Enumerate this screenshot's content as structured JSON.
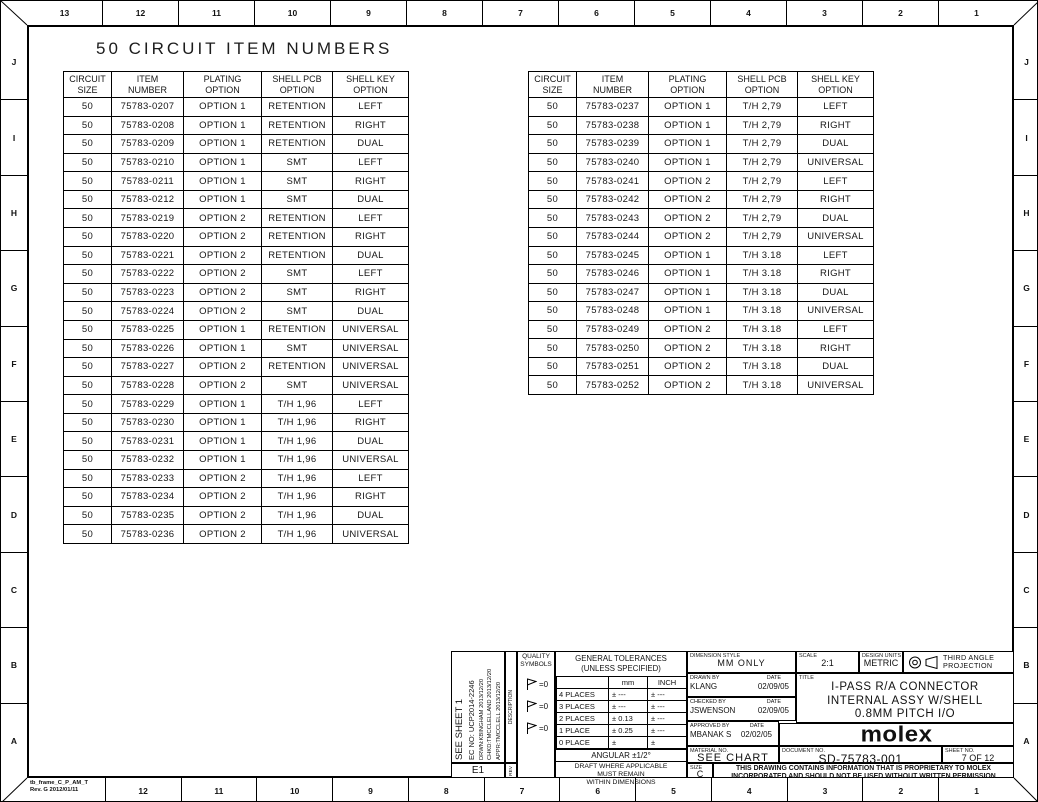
{
  "page": {
    "title": "50 CIRCUIT ITEM NUMBERS"
  },
  "border": {
    "top_labels": [
      "13",
      "12",
      "11",
      "10",
      "9",
      "8",
      "7",
      "6",
      "5",
      "4",
      "3",
      "2",
      "1"
    ],
    "bottom_labels": [
      "12",
      "11",
      "10",
      "9",
      "8",
      "7",
      "6",
      "5",
      "4",
      "3",
      "2",
      "1"
    ],
    "side_labels": [
      "J",
      "I",
      "H",
      "G",
      "F",
      "E",
      "D",
      "C",
      "B",
      "A"
    ],
    "frame_note": "tb_frame_C_P_AM_T\nRev. G 2012/01/11"
  },
  "tables": {
    "headers": [
      "CIRCUIT\nSIZE",
      "ITEM\nNUMBER",
      "PLATING\nOPTION",
      "SHELL PCB\nOPTION",
      "SHELL KEY\nOPTION"
    ],
    "left_rows": [
      [
        "50",
        "75783-0207",
        "OPTION 1",
        "RETENTION",
        "LEFT"
      ],
      [
        "50",
        "75783-0208",
        "OPTION 1",
        "RETENTION",
        "RIGHT"
      ],
      [
        "50",
        "75783-0209",
        "OPTION 1",
        "RETENTION",
        "DUAL"
      ],
      [
        "50",
        "75783-0210",
        "OPTION 1",
        "SMT",
        "LEFT"
      ],
      [
        "50",
        "75783-0211",
        "OPTION 1",
        "SMT",
        "RIGHT"
      ],
      [
        "50",
        "75783-0212",
        "OPTION 1",
        "SMT",
        "DUAL"
      ],
      [
        "50",
        "75783-0219",
        "OPTION 2",
        "RETENTION",
        "LEFT"
      ],
      [
        "50",
        "75783-0220",
        "OPTION 2",
        "RETENTION",
        "RIGHT"
      ],
      [
        "50",
        "75783-0221",
        "OPTION 2",
        "RETENTION",
        "DUAL"
      ],
      [
        "50",
        "75783-0222",
        "OPTION 2",
        "SMT",
        "LEFT"
      ],
      [
        "50",
        "75783-0223",
        "OPTION 2",
        "SMT",
        "RIGHT"
      ],
      [
        "50",
        "75783-0224",
        "OPTION 2",
        "SMT",
        "DUAL"
      ],
      [
        "50",
        "75783-0225",
        "OPTION 1",
        "RETENTION",
        "UNIVERSAL"
      ],
      [
        "50",
        "75783-0226",
        "OPTION 1",
        "SMT",
        "UNIVERSAL"
      ],
      [
        "50",
        "75783-0227",
        "OPTION 2",
        "RETENTION",
        "UNIVERSAL"
      ],
      [
        "50",
        "75783-0228",
        "OPTION 2",
        "SMT",
        "UNIVERSAL"
      ],
      [
        "50",
        "75783-0229",
        "OPTION 1",
        "T/H 1,96",
        "LEFT"
      ],
      [
        "50",
        "75783-0230",
        "OPTION 1",
        "T/H 1,96",
        "RIGHT"
      ],
      [
        "50",
        "75783-0231",
        "OPTION 1",
        "T/H 1,96",
        "DUAL"
      ],
      [
        "50",
        "75783-0232",
        "OPTION 1",
        "T/H 1,96",
        "UNIVERSAL"
      ],
      [
        "50",
        "75783-0233",
        "OPTION 2",
        "T/H 1,96",
        "LEFT"
      ],
      [
        "50",
        "75783-0234",
        "OPTION 2",
        "T/H 1,96",
        "RIGHT"
      ],
      [
        "50",
        "75783-0235",
        "OPTION 2",
        "T/H 1,96",
        "DUAL"
      ],
      [
        "50",
        "75783-0236",
        "OPTION 2",
        "T/H 1,96",
        "UNIVERSAL"
      ]
    ],
    "right_rows": [
      [
        "50",
        "75783-0237",
        "OPTION 1",
        "T/H 2,79",
        "LEFT"
      ],
      [
        "50",
        "75783-0238",
        "OPTION 1",
        "T/H 2,79",
        "RIGHT"
      ],
      [
        "50",
        "75783-0239",
        "OPTION 1",
        "T/H 2,79",
        "DUAL"
      ],
      [
        "50",
        "75783-0240",
        "OPTION 1",
        "T/H 2,79",
        "UNIVERSAL"
      ],
      [
        "50",
        "75783-0241",
        "OPTION 2",
        "T/H 2,79",
        "LEFT"
      ],
      [
        "50",
        "75783-0242",
        "OPTION 2",
        "T/H 2,79",
        "RIGHT"
      ],
      [
        "50",
        "75783-0243",
        "OPTION 2",
        "T/H 2,79",
        "DUAL"
      ],
      [
        "50",
        "75783-0244",
        "OPTION 2",
        "T/H 2,79",
        "UNIVERSAL"
      ],
      [
        "50",
        "75783-0245",
        "OPTION 1",
        "T/H 3.18",
        "LEFT"
      ],
      [
        "50",
        "75783-0246",
        "OPTION 1",
        "T/H 3.18",
        "RIGHT"
      ],
      [
        "50",
        "75783-0247",
        "OPTION 1",
        "T/H 3.18",
        "DUAL"
      ],
      [
        "50",
        "75783-0248",
        "OPTION 1",
        "T/H 3.18",
        "UNIVERSAL"
      ],
      [
        "50",
        "75783-0249",
        "OPTION 2",
        "T/H 3.18",
        "LEFT"
      ],
      [
        "50",
        "75783-0250",
        "OPTION 2",
        "T/H 3.18",
        "RIGHT"
      ],
      [
        "50",
        "75783-0251",
        "OPTION 2",
        "T/H 3.18",
        "DUAL"
      ],
      [
        "50",
        "75783-0252",
        "OPTION 2",
        "T/H 3.18",
        "UNIVERSAL"
      ]
    ]
  },
  "title_block": {
    "revision": {
      "see_sheet": "SEE SHEET 1",
      "ec_no": "EC NO: UCP2014-2246",
      "drwn": "DRWN:KBINGHAM  2013/12/20",
      "chkd": "CHKD:TMCCLELLAND 2013/12/20",
      "appr": "APPR:TMCCLELL  2013/12/20",
      "rev_value": "E1",
      "description_label": "DESCRIPTION",
      "rev_label": "REV"
    },
    "quality": {
      "header": "QUALITY\nSYMBOLS",
      "symbol_text": "=0"
    },
    "tolerances": {
      "header": "GENERAL TOLERANCES\n(UNLESS SPECIFIED)",
      "col_mm": "mm",
      "col_inch": "INCH",
      "rows": [
        [
          "4 PLACES",
          "± ---",
          "± ---"
        ],
        [
          "3 PLACES",
          "± ---",
          "± ---"
        ],
        [
          "2 PLACES",
          "± 0.13",
          "± ---"
        ],
        [
          "1 PLACE",
          "± 0.25",
          "± ---"
        ],
        [
          "0 PLACE",
          "±",
          "±"
        ]
      ],
      "angular": "ANGULAR ±1/2°",
      "draft_note": "DRAFT WHERE APPLICABLE\nMUST REMAIN\nWITHIN DIMENSIONS"
    },
    "info": {
      "dimension_style_label": "DIMENSION STYLE",
      "dimension_style": "MM ONLY",
      "scale_label": "SCALE",
      "scale": "2:1",
      "units_label": "DESIGN UNITS",
      "units": "METRIC",
      "projection_label": "THIRD ANGLE\nPROJECTION",
      "drawn_by_label": "DRAWN BY",
      "drawn_by": "KLANG",
      "drawn_date": "02/09/05",
      "checked_by_label": "CHECKED BY",
      "checked_by": "JSWENSON",
      "checked_date": "02/09/05",
      "approved_by_label": "APPROVED BY",
      "approved_by": "MBANAK S",
      "approved_date": "02/02/05",
      "date_label": "DATE",
      "material_label": "MATERIAL NO.",
      "material": "SEE CHART",
      "title_label": "TITLE",
      "title_line1": "I-PASS R/A CONNECTOR",
      "title_line2": "INTERNAL ASSY W/SHELL",
      "title_line3": "0.8MM PITCH I/O",
      "logo": "molex",
      "document_label": "DOCUMENT NO.",
      "document": "SD-75783-001",
      "sheet_label": "SHEET NO.",
      "sheet": "7 OF 12",
      "size_label": "SIZE",
      "size": "C",
      "proprietary": "THIS DRAWING CONTAINS INFORMATION THAT IS PROPRIETARY TO MOLEX\nINCORPORATED AND SHOULD NOT BE USED WITHOUT WRITTEN PERMISSION"
    }
  }
}
